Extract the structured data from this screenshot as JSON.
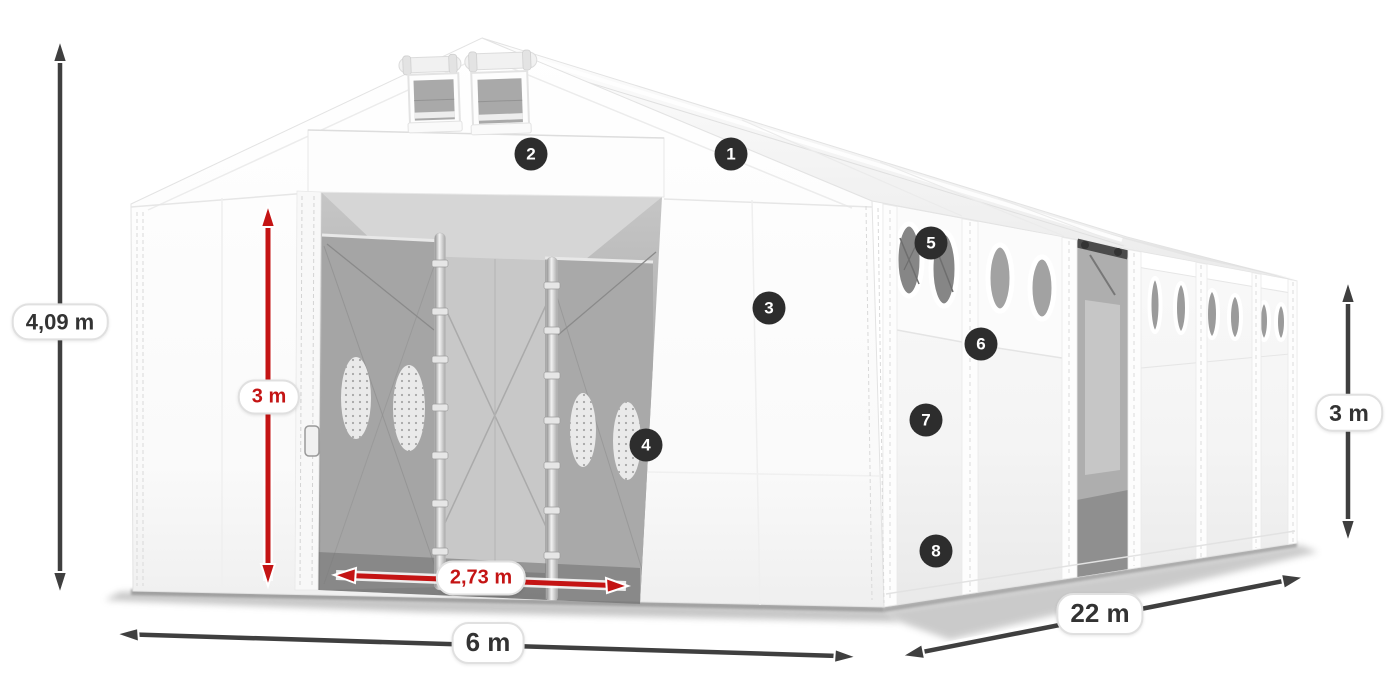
{
  "dimensions": {
    "total_height": "4,09 m",
    "entrance_height": "3 m",
    "entrance_width": "2,73 m",
    "front_width": "6 m",
    "side_length": "22 m",
    "side_wall_height": "3 m"
  },
  "hotspots": [
    {
      "number": "1"
    },
    {
      "number": "2"
    },
    {
      "number": "3"
    },
    {
      "number": "4"
    },
    {
      "number": "5"
    },
    {
      "number": "6"
    },
    {
      "number": "7"
    },
    {
      "number": "8"
    }
  ],
  "colors": {
    "dimension_arrow_dark": "#3f3f3f",
    "dimension_arrow_red": "#c41414",
    "hotspot_background": "#2d2d2d",
    "label_text": "#333333",
    "tent_fabric": "#ffffff"
  }
}
